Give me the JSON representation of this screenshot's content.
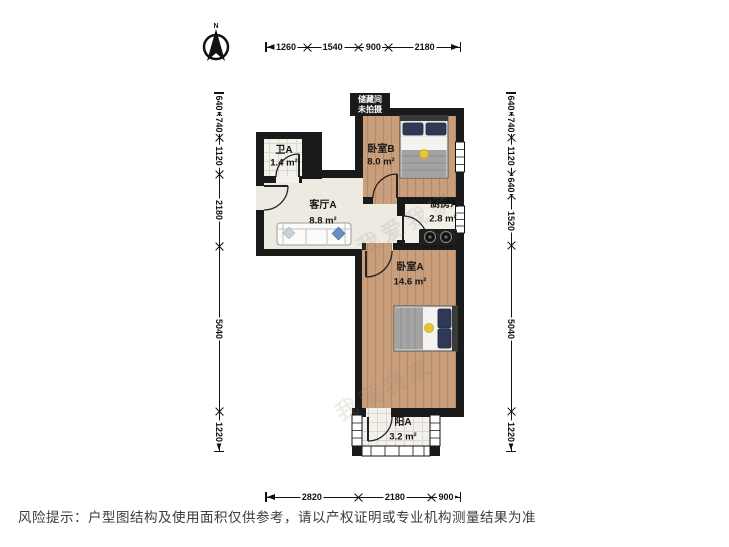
{
  "compass": {
    "n": "N"
  },
  "storage": {
    "line1": "储藏间",
    "line2": "未拍摄"
  },
  "rooms": [
    {
      "id": "bathroom",
      "name": "卫A",
      "area": "1.4 m²"
    },
    {
      "id": "living",
      "name": "客厅A",
      "area": "8.8 m²"
    },
    {
      "id": "bedroom-b",
      "name": "卧室B",
      "area": "8.0 m²"
    },
    {
      "id": "kitchen",
      "name": "厨房A",
      "area": "2.8 m²"
    },
    {
      "id": "bedroom-a",
      "name": "卧室A",
      "area": "14.6 m²"
    },
    {
      "id": "balcony",
      "name": "阳A",
      "area": "3.2 m²"
    }
  ],
  "dimensions": {
    "top": [
      1260,
      1540,
      900,
      2180
    ],
    "bottom": [
      2820,
      2180,
      900
    ],
    "left": [
      640,
      740,
      1120,
      2180,
      5040,
      1220
    ],
    "right": [
      640,
      740,
      1120,
      640,
      1520,
      5040,
      1220
    ]
  },
  "watermark": "我爱我家",
  "footer": {
    "text": "风险提示：户型图结构及使用面积仅供参考，请以产权证明或专业机构测量结果为准"
  },
  "colors": {
    "wall": "#1a1a1a",
    "wood": "#c89e7b",
    "tile": "#f3f1ec",
    "accent_yellow": "#e8c437",
    "pillow_navy": "#2e3a55"
  }
}
